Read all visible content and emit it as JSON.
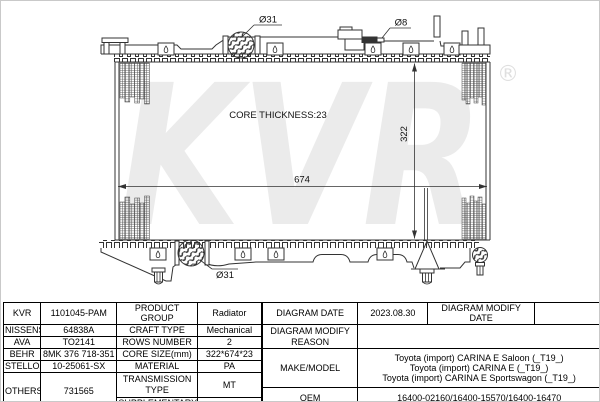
{
  "colors": {
    "line": "#333333",
    "watermark": "#ebebeb",
    "table_border": "#000000"
  },
  "drawing": {
    "watermark": {
      "text": "KVR",
      "registered": "®"
    },
    "labels": {
      "top_pipe_diameter": "Ø31",
      "vent_pipe_diameter": "Ø8",
      "core_thickness": "CORE THICKNESS:23",
      "core_width": "674",
      "core_height": "322",
      "bottom_pipe_diameter": "Ø31"
    }
  },
  "table": {
    "left": {
      "rows": [
        {
          "brand": "KVR",
          "brand_value": "1101045-PAM",
          "label": "PRODUCT GROUP",
          "value": "Radiator"
        },
        {
          "brand": "NISSENS",
          "brand_value": "64838A",
          "label": "CRAFT TYPE",
          "value": "Mechanical"
        },
        {
          "brand": "AVA",
          "brand_value": "TO2141",
          "label": "ROWS NUMBER",
          "value": "2"
        },
        {
          "brand": "BEHR",
          "brand_value": "8MK 376 718-351",
          "label": "CORE SIZE(mm)",
          "value": "322*674*23"
        },
        {
          "brand": "STELLOX",
          "brand_value": "10-25061-SX",
          "label": "MATERIAL",
          "value": "PA"
        },
        {
          "brand": "OTHERS",
          "brand_value": "731565",
          "label": "TRANSMISSION TYPE",
          "value": "MT"
        },
        {
          "label": "SUPPLEMENTARY",
          "value": ""
        }
      ]
    },
    "right": {
      "diagram_date_label": "DIAGRAM DATE",
      "diagram_date": "2023.08.30",
      "diagram_modify_date_label": "DIAGRAM MODIFY DATE",
      "diagram_modify_date": "",
      "diagram_modify_reason_label": "DIAGRAM MODIFY REASON",
      "diagram_modify_reason": "",
      "make_model_label": "MAKE/MODEL",
      "make_model": [
        "Toyota (import) CARINA E Saloon (_T19_)",
        "Toyota (import) CARINA E (_T19_)",
        "Toyota (import) CARINA E Sportswagon (_T19_)"
      ],
      "oem_label": "OEM",
      "oem": "16400-02160/16400-15570/16400-16470"
    }
  }
}
